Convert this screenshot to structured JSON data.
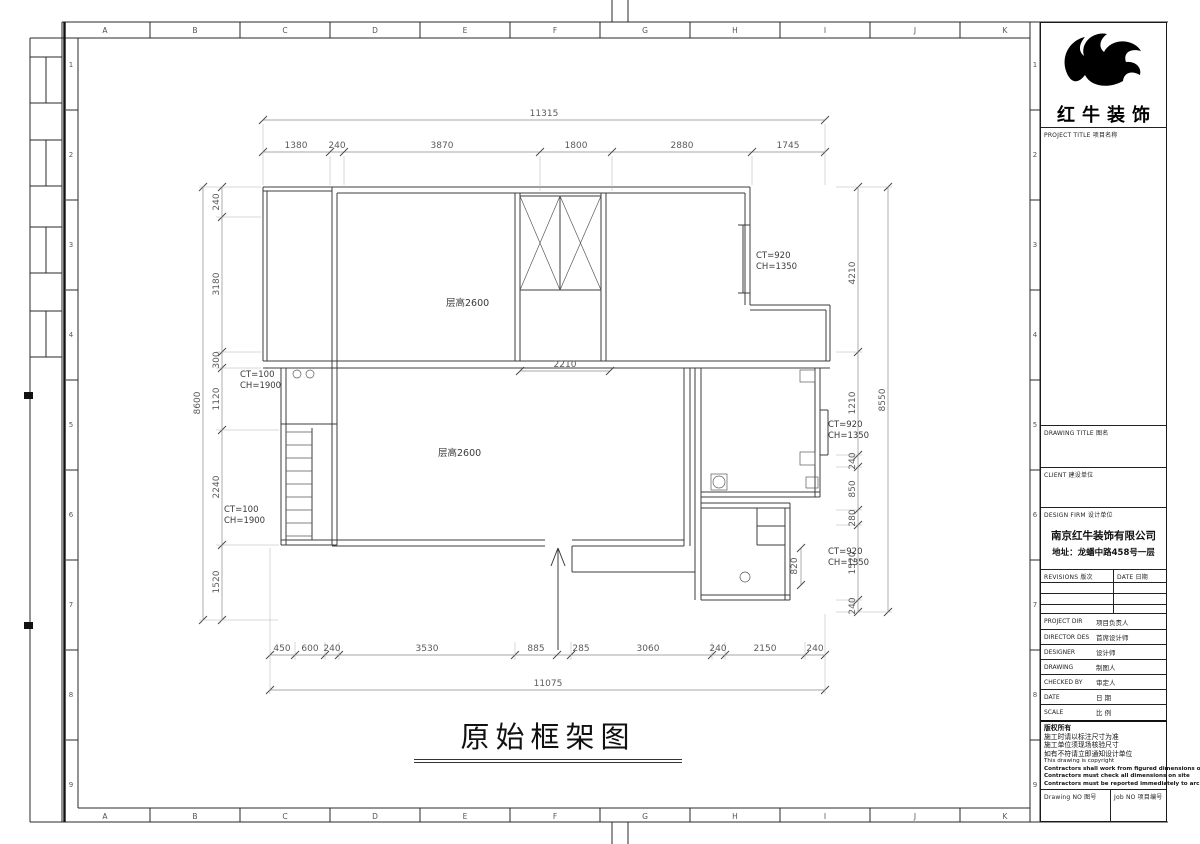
{
  "sheet": {
    "plan_title": "原始框架图",
    "rulers": {
      "letters": [
        "A",
        "B",
        "C",
        "D",
        "E",
        "F",
        "G",
        "H",
        "I",
        "J",
        "K"
      ],
      "numbers": [
        "1",
        "2",
        "3",
        "4",
        "5",
        "6",
        "7",
        "8",
        "9"
      ]
    }
  },
  "plan": {
    "labels": {
      "room_upper": "层高2600",
      "room_lower": "层高2600"
    },
    "windows": [
      {
        "l1": "CT=100",
        "l2": "CH=1900"
      },
      {
        "l1": "CT=100",
        "l2": "CH=1900"
      },
      {
        "l1": "CT=920",
        "l2": "CH=1350"
      },
      {
        "l1": "CT=920",
        "l2": "CH=1350"
      },
      {
        "l1": "CT=920",
        "l2": "CH=1350"
      }
    ],
    "dims": {
      "top_total": "11315",
      "top": [
        "1380",
        "240",
        "3870",
        "1800",
        "2880",
        "1745"
      ],
      "bottom": [
        "450",
        "600",
        "240",
        "3530",
        "885",
        "285",
        "3060",
        "240",
        "2150",
        "240"
      ],
      "bottom_total": "11075",
      "left": [
        "240",
        "3180",
        "300",
        "1120",
        "2240",
        "1520"
      ],
      "left_total": "8600",
      "right": [
        "4210",
        "1210",
        "240",
        "850",
        "280",
        "1520",
        "240"
      ],
      "right_total": "8550",
      "opening": "2210",
      "door": "820"
    }
  },
  "title_block": {
    "brand": "红牛装饰",
    "project_title": "PROJECT TITLE  项目名称",
    "drawing_title": "DRAWING TITLE  图名",
    "client": "CLIENT  建设单位",
    "design_firm": "DESIGN FIRM  设计单位",
    "firm_name": "南京红牛装饰有限公司",
    "firm_address": "地址：龙蟠中路458号一层",
    "revisions": "REVISIONS  版次",
    "date_header": "DATE 日期",
    "rows": [
      {
        "en": "PROJECT DIR",
        "zh": "项目负责人"
      },
      {
        "en": "DIRECTOR DES",
        "zh": "首席设计师"
      },
      {
        "en": "DESIGNER",
        "zh": "设计师"
      },
      {
        "en": "DRAWING",
        "zh": "制图人"
      },
      {
        "en": "CHECKED BY",
        "zh": "审定人"
      },
      {
        "en": "DATE",
        "zh": "日  期"
      },
      {
        "en": "SCALE",
        "zh": "比  例"
      }
    ],
    "notes": [
      "版权所有",
      "施工时请以标注尺寸为准",
      "施工单位须现场核验尺寸",
      "如有不符请立即通知设计单位",
      "This drawing is copyright",
      "Contractors shall work from figured dimensions only",
      "Contractors must check all dimensions on site",
      "Contractors must be reported immediately to architects"
    ],
    "drawing_no": "Drawing NO  图号",
    "job_no": "Job NO  项目编号"
  }
}
